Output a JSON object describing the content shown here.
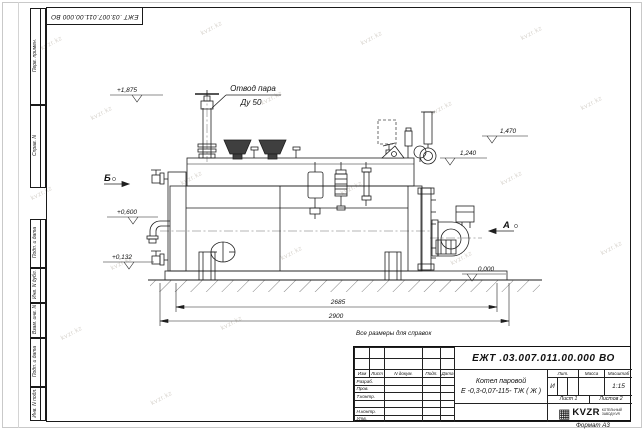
{
  "sheet": {
    "doc_number": "ЕЖТ .03.007.011.00.000  ВО",
    "format_note": "Формат А3",
    "reference_note": "Все размеры для справок"
  },
  "watermark": {
    "text": "kvzr.kz"
  },
  "frame_stamps": {
    "top": [
      "Перв. примен.",
      "Справ. N"
    ],
    "bottom": [
      "Подп. и дата",
      "Инв. N дубл.",
      "Взам. инв. N",
      "Подп. и дата",
      "Инв. N подл."
    ]
  },
  "drawing": {
    "steam_outlet_label": "Отвод пара",
    "steam_outlet_size": "Ду 50",
    "view_b": "Б",
    "view_a": "А",
    "elev_top": "+1,875",
    "elev_1470": "1,470",
    "elev_1240": "1,240",
    "elev_0600": "+0,600",
    "elev_0132": "+0,132",
    "elev_zero": "0,000",
    "dim_inner": "2685",
    "dim_overall": "2900"
  },
  "title_block": {
    "doc_number": "ЕЖТ .03.007.011.00.000  ВО",
    "product_name": "Котел паровой",
    "product_code": "Е -0,3-0,07-115- ТЖ ( Ж )",
    "col_izm": "Изм",
    "col_list": "Лист",
    "col_doc": "N докум.",
    "col_podp": "Подп.",
    "col_data": "Дата",
    "row_razrab": "Разраб.",
    "row_prov": "Пров.",
    "row_tkontr": "Т.контр.",
    "row_nkontr": "Н.контр.",
    "row_utv": "Утв.",
    "lit_header": "Лит.",
    "mass_header": "Масса",
    "scale_header": "Масштаб",
    "lit_value": "И",
    "scale_value": "1:15",
    "sheet_info": "Лист 1",
    "sheets_info": "Листов 2",
    "logo_mark": "▦",
    "logo_text": "KVZR",
    "logo_sub1": "КОТЕЛЬНЫЙ",
    "logo_sub2": "ЗАВОД KVR"
  }
}
